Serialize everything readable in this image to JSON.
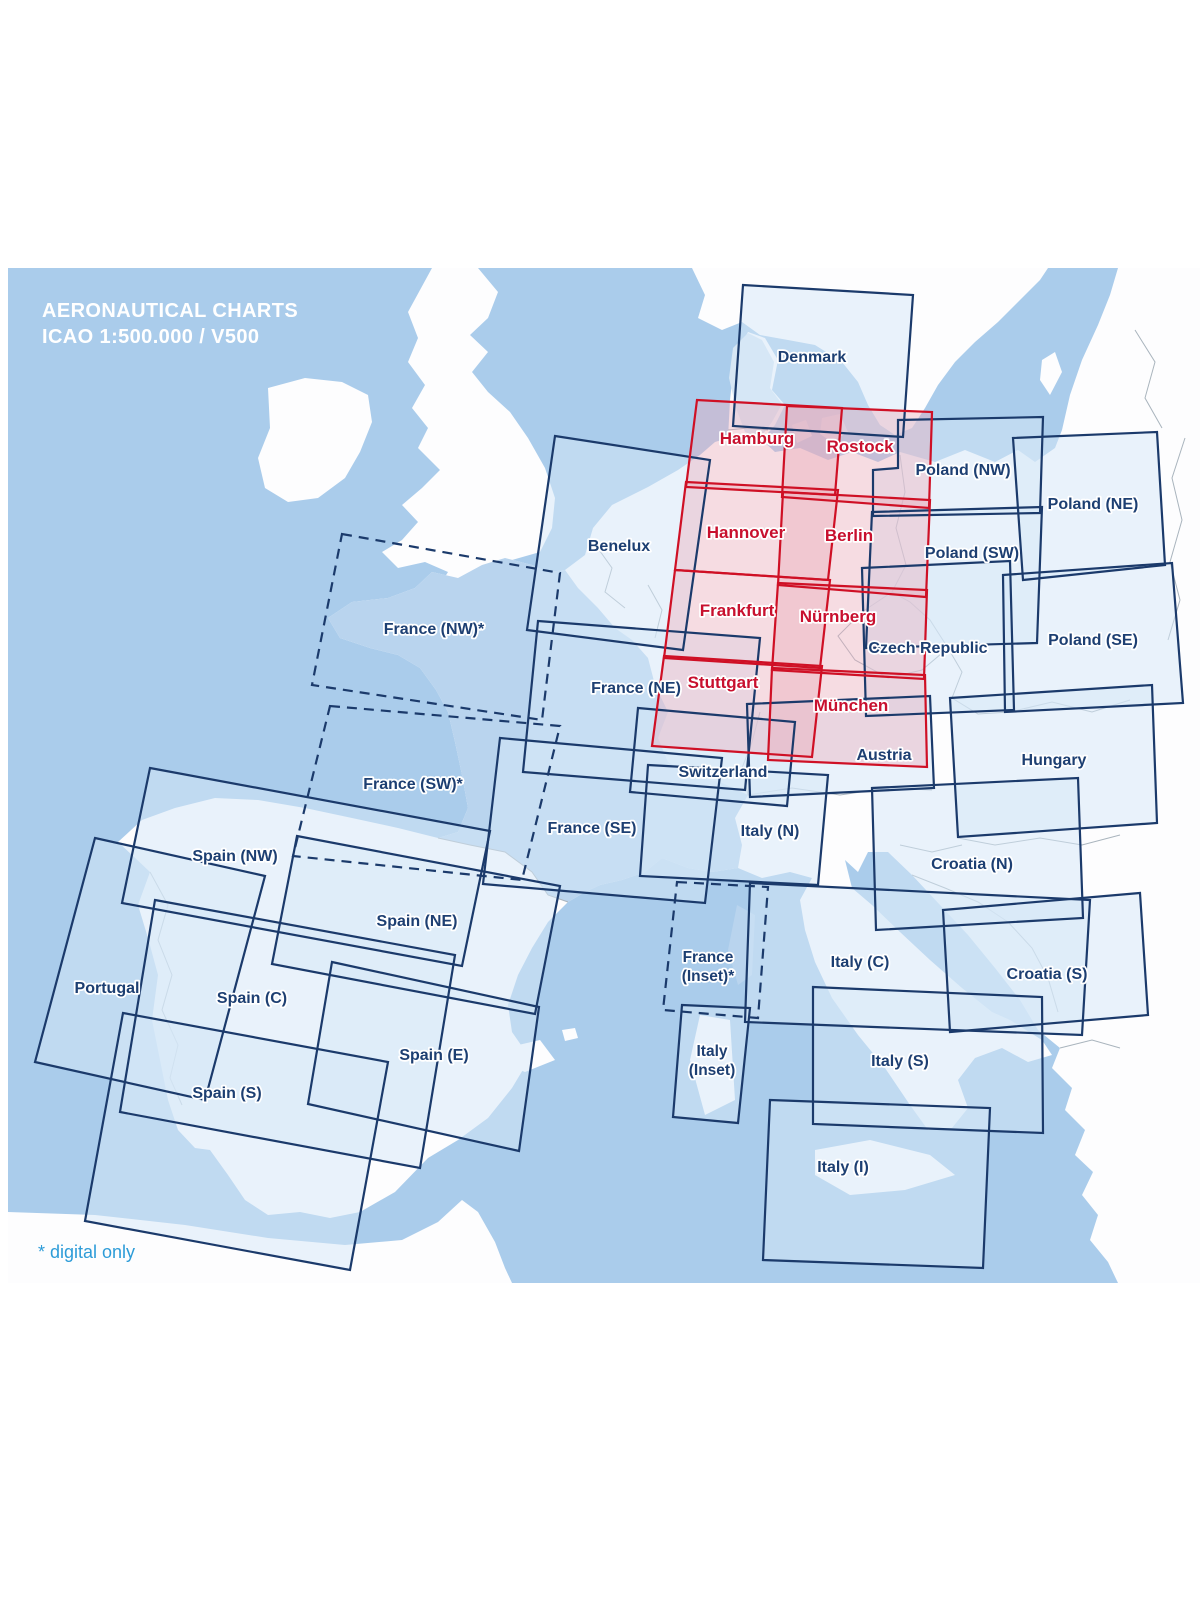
{
  "title": {
    "line1": "AERONAUTICAL CHARTS",
    "line2": "ICAO 1:500.000 / V500"
  },
  "footnote": "* digital only",
  "colors": {
    "sea": "#aacceb",
    "land": "#fdfdfe",
    "france_land": "#b9d4ee",
    "denmark_land": "#d6e6f4",
    "chart_outline": "#1b3a6b",
    "chart_fill": "rgba(214,232,247,0.5)",
    "german_chart_outline": "#cf1025",
    "german_chart_fill": "rgba(235,170,185,0.4)",
    "label_navy": "#1d3f72",
    "label_red": "#c8102e",
    "border_gray": "#a9b4bd",
    "title_white": "#ffffff",
    "footnote_blue": "#2d9cd8"
  },
  "charts": [
    {
      "id": "denmark",
      "label": "Denmark",
      "series": "standard",
      "style": "solid",
      "points": [
        [
          743,
          285
        ],
        [
          913,
          295
        ],
        [
          903,
          437
        ],
        [
          733,
          426
        ]
      ],
      "label_pos": [
        812,
        362
      ]
    },
    {
      "id": "poland-nw",
      "label": "Poland (NW)",
      "series": "standard",
      "style": "solid",
      "points": [
        [
          898,
          420
        ],
        [
          1043,
          417
        ],
        [
          1040,
          513
        ],
        [
          873,
          516
        ],
        [
          873,
          470
        ],
        [
          898,
          468
        ]
      ],
      "label_pos": [
        963,
        475
      ]
    },
    {
      "id": "poland-ne",
      "label": "Poland (NE)",
      "series": "standard",
      "style": "solid",
      "points": [
        [
          1013,
          438
        ],
        [
          1157,
          432
        ],
        [
          1165,
          565
        ],
        [
          1023,
          580
        ]
      ],
      "label_pos": [
        1093,
        509
      ]
    },
    {
      "id": "poland-sw",
      "label": "Poland (SW)",
      "series": "standard",
      "style": "solid",
      "points": [
        [
          872,
          512
        ],
        [
          1042,
          507
        ],
        [
          1037,
          643
        ],
        [
          866,
          648
        ]
      ],
      "label_pos": [
        972,
        558
      ]
    },
    {
      "id": "poland-se",
      "label": "Poland (SE)",
      "series": "standard",
      "style": "solid",
      "points": [
        [
          1003,
          575
        ],
        [
          1172,
          563
        ],
        [
          1183,
          703
        ],
        [
          1005,
          712
        ]
      ],
      "label_pos": [
        1093,
        645
      ]
    },
    {
      "id": "czech-republic",
      "label": "Czech Republic",
      "series": "standard",
      "style": "solid",
      "points": [
        [
          862,
          568
        ],
        [
          1010,
          561
        ],
        [
          1014,
          710
        ],
        [
          866,
          716
        ]
      ],
      "label_pos": [
        928,
        653
      ]
    },
    {
      "id": "benelux",
      "label": "Benelux",
      "series": "standard",
      "style": "solid",
      "points": [
        [
          555,
          436
        ],
        [
          710,
          460
        ],
        [
          683,
          650
        ],
        [
          527,
          630
        ]
      ],
      "label_pos": [
        619,
        551
      ]
    },
    {
      "id": "france-ne",
      "label": "France (NE)",
      "series": "standard",
      "style": "solid",
      "points": [
        [
          538,
          621
        ],
        [
          760,
          638
        ],
        [
          745,
          790
        ],
        [
          523,
          772
        ]
      ],
      "label_pos": [
        636,
        693
      ]
    },
    {
      "id": "france-se",
      "label": "France (SE)",
      "series": "standard",
      "style": "solid",
      "points": [
        [
          500,
          738
        ],
        [
          722,
          758
        ],
        [
          705,
          903
        ],
        [
          483,
          884
        ]
      ],
      "label_pos": [
        592,
        833
      ]
    },
    {
      "id": "switzerland",
      "label": "Switzerland",
      "series": "standard",
      "style": "solid",
      "points": [
        [
          638,
          708
        ],
        [
          795,
          722
        ],
        [
          787,
          806
        ],
        [
          630,
          792
        ]
      ],
      "label_pos": [
        723,
        777
      ]
    },
    {
      "id": "italy-n",
      "label": "Italy (N)",
      "series": "standard",
      "style": "solid",
      "points": [
        [
          648,
          765
        ],
        [
          828,
          775
        ],
        [
          818,
          885
        ],
        [
          640,
          876
        ]
      ],
      "label_pos": [
        770,
        836
      ]
    },
    {
      "id": "austria",
      "label": "Austria",
      "series": "standard",
      "style": "solid",
      "points": [
        [
          747,
          704
        ],
        [
          930,
          696
        ],
        [
          934,
          788
        ],
        [
          750,
          797
        ]
      ],
      "label_pos": [
        884,
        760
      ]
    },
    {
      "id": "hungary",
      "label": "Hungary",
      "series": "standard",
      "style": "solid",
      "points": [
        [
          950,
          698
        ],
        [
          1152,
          685
        ],
        [
          1157,
          823
        ],
        [
          958,
          837
        ]
      ],
      "label_pos": [
        1054,
        765
      ]
    },
    {
      "id": "croatia-n",
      "label": "Croatia (N)",
      "series": "standard",
      "style": "solid",
      "points": [
        [
          872,
          788
        ],
        [
          1078,
          778
        ],
        [
          1083,
          918
        ],
        [
          876,
          930
        ]
      ],
      "label_pos": [
        972,
        869
      ]
    },
    {
      "id": "croatia-s",
      "label": "Croatia (S)",
      "series": "standard",
      "style": "solid",
      "points": [
        [
          943,
          910
        ],
        [
          1140,
          893
        ],
        [
          1148,
          1015
        ],
        [
          950,
          1032
        ]
      ],
      "label_pos": [
        1047,
        979
      ]
    },
    {
      "id": "italy-c",
      "label": "Italy (C)",
      "series": "standard",
      "style": "solid",
      "points": [
        [
          750,
          883
        ],
        [
          1090,
          900
        ],
        [
          1082,
          1035
        ],
        [
          745,
          1022
        ]
      ],
      "label_pos": [
        860,
        967
      ]
    },
    {
      "id": "italy-s",
      "label": "Italy (S)",
      "series": "standard",
      "style": "solid",
      "points": [
        [
          813,
          987
        ],
        [
          1042,
          997
        ],
        [
          1043,
          1133
        ],
        [
          813,
          1124
        ]
      ],
      "label_pos": [
        900,
        1066
      ]
    },
    {
      "id": "italy-i",
      "label": "Italy (I)",
      "series": "standard",
      "style": "solid",
      "points": [
        [
          770,
          1100
        ],
        [
          990,
          1108
        ],
        [
          983,
          1268
        ],
        [
          763,
          1260
        ]
      ],
      "label_pos": [
        843,
        1172
      ]
    },
    {
      "id": "italy-inset",
      "label": "Italy",
      "label2": "(Inset)",
      "series": "standard",
      "style": "solid",
      "points": [
        [
          682,
          1005
        ],
        [
          750,
          1008
        ],
        [
          738,
          1123
        ],
        [
          673,
          1117
        ]
      ],
      "label_pos": [
        712,
        1056
      ]
    },
    {
      "id": "spain-nw",
      "label": "Spain (NW)",
      "series": "standard",
      "style": "solid",
      "points": [
        [
          150,
          768
        ],
        [
          490,
          831
        ],
        [
          462,
          966
        ],
        [
          122,
          903
        ]
      ],
      "label_pos": [
        235,
        861
      ]
    },
    {
      "id": "spain-ne",
      "label": "Spain (NE)",
      "series": "standard",
      "style": "solid",
      "points": [
        [
          297,
          836
        ],
        [
          560,
          886
        ],
        [
          535,
          1014
        ],
        [
          272,
          964
        ]
      ],
      "label_pos": [
        417,
        926
      ]
    },
    {
      "id": "portugal",
      "label": "Portugal",
      "series": "standard",
      "style": "solid",
      "points": [
        [
          95,
          838
        ],
        [
          265,
          876
        ],
        [
          205,
          1100
        ],
        [
          35,
          1062
        ]
      ],
      "label_pos": [
        107,
        993
      ]
    },
    {
      "id": "spain-c",
      "label": "Spain (C)",
      "series": "standard",
      "style": "solid",
      "points": [
        [
          155,
          900
        ],
        [
          455,
          955
        ],
        [
          420,
          1168
        ],
        [
          120,
          1112
        ]
      ],
      "label_pos": [
        252,
        1003
      ]
    },
    {
      "id": "spain-e",
      "label": "Spain (E)",
      "series": "standard",
      "style": "solid",
      "points": [
        [
          332,
          962
        ],
        [
          539,
          1007
        ],
        [
          519,
          1151
        ],
        [
          308,
          1104
        ]
      ],
      "label_pos": [
        434,
        1060
      ]
    },
    {
      "id": "spain-s",
      "label": "Spain (S)",
      "series": "standard",
      "style": "solid",
      "points": [
        [
          123,
          1013
        ],
        [
          388,
          1062
        ],
        [
          350,
          1270
        ],
        [
          85,
          1221
        ]
      ],
      "label_pos": [
        227,
        1098
      ]
    },
    {
      "id": "france-nw",
      "label": "France (NW)*",
      "series": "standard",
      "style": "dashed",
      "points": [
        [
          342,
          534
        ],
        [
          560,
          573
        ],
        [
          542,
          720
        ],
        [
          312,
          685
        ]
      ],
      "label_pos": [
        434,
        634
      ]
    },
    {
      "id": "france-sw",
      "label": "France (SW)*",
      "series": "standard",
      "style": "dashed",
      "points": [
        [
          330,
          706
        ],
        [
          560,
          726
        ],
        [
          522,
          880
        ],
        [
          293,
          856
        ]
      ],
      "label_pos": [
        413,
        789
      ]
    },
    {
      "id": "france-inset",
      "label": "France",
      "label2": "(Inset)*",
      "series": "standard",
      "style": "dashed",
      "points": [
        [
          677,
          882
        ],
        [
          768,
          887
        ],
        [
          758,
          1018
        ],
        [
          663,
          1010
        ]
      ],
      "label_pos": [
        708,
        962
      ]
    },
    {
      "id": "hamburg",
      "label": "Hamburg",
      "series": "germany",
      "style": "solid",
      "points": [
        [
          697,
          400
        ],
        [
          842,
          408
        ],
        [
          835,
          495
        ],
        [
          686,
          487
        ]
      ],
      "label_pos": [
        757,
        444
      ]
    },
    {
      "id": "rostock",
      "label": "Rostock",
      "series": "germany",
      "style": "solid",
      "points": [
        [
          787,
          406
        ],
        [
          932,
          412
        ],
        [
          929,
          508
        ],
        [
          782,
          497
        ]
      ],
      "label_pos": [
        860,
        452
      ]
    },
    {
      "id": "hannover",
      "label": "Hannover",
      "series": "germany",
      "style": "solid",
      "points": [
        [
          686,
          482
        ],
        [
          838,
          490
        ],
        [
          828,
          580
        ],
        [
          675,
          570
        ]
      ],
      "label_pos": [
        746,
        538
      ]
    },
    {
      "id": "berlin",
      "label": "Berlin",
      "series": "germany",
      "style": "solid",
      "points": [
        [
          783,
          492
        ],
        [
          930,
          500
        ],
        [
          926,
          597
        ],
        [
          778,
          585
        ]
      ],
      "label_pos": [
        849,
        541
      ]
    },
    {
      "id": "frankfurt",
      "label": "Frankfurt",
      "series": "germany",
      "style": "solid",
      "points": [
        [
          675,
          570
        ],
        [
          830,
          580
        ],
        [
          820,
          668
        ],
        [
          664,
          658
        ]
      ],
      "label_pos": [
        737,
        616
      ]
    },
    {
      "id": "nurnberg",
      "label": "Nürnberg",
      "series": "germany",
      "style": "solid",
      "points": [
        [
          778,
          583
        ],
        [
          927,
          590
        ],
        [
          924,
          679
        ],
        [
          772,
          670
        ]
      ],
      "label_pos": [
        838,
        622
      ]
    },
    {
      "id": "stuttgart",
      "label": "Stuttgart",
      "series": "germany",
      "style": "solid",
      "points": [
        [
          664,
          656
        ],
        [
          822,
          666
        ],
        [
          812,
          757
        ],
        [
          652,
          746
        ]
      ],
      "label_pos": [
        723,
        688
      ]
    },
    {
      "id": "munchen",
      "label": "München",
      "series": "germany",
      "style": "solid",
      "points": [
        [
          772,
          668
        ],
        [
          925,
          675
        ],
        [
          927,
          767
        ],
        [
          768,
          760
        ]
      ],
      "label_pos": [
        851,
        711
      ]
    }
  ]
}
